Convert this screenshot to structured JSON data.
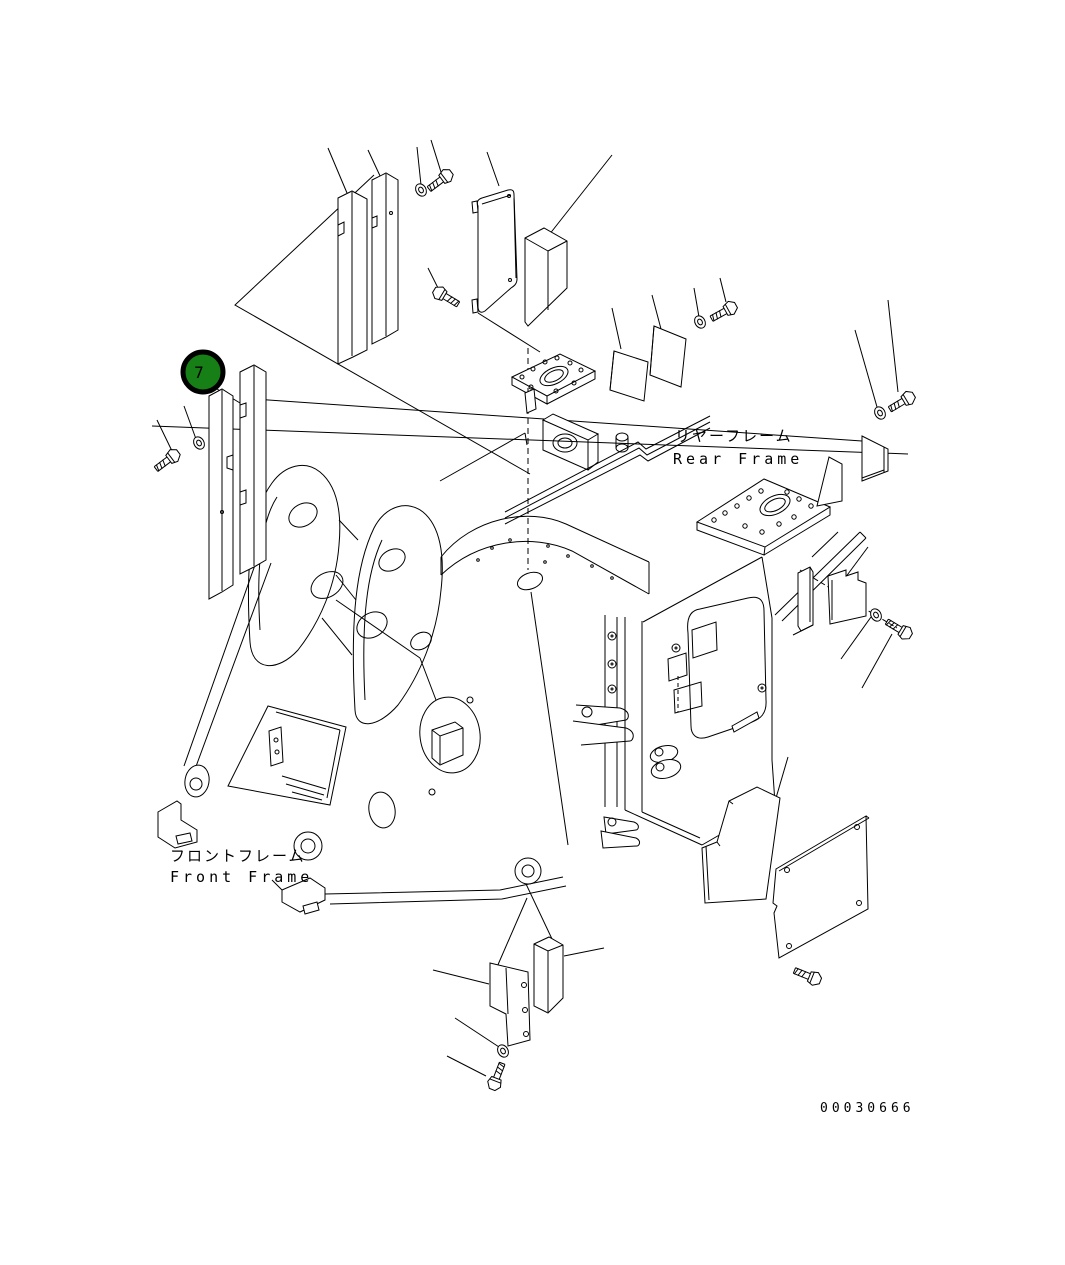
{
  "diagram": {
    "type": "parts-exploded-diagram",
    "drawing_number": "00030666",
    "callout": {
      "number": "7"
    },
    "labels": {
      "rear_frame_jp": "リヤーフレーム",
      "rear_frame_en": "Rear Frame",
      "front_frame_jp": "フロントフレーム",
      "front_frame_en": "Front Frame"
    },
    "colors": {
      "background": "#ffffff",
      "line": "#000000",
      "callout_fill": "#168016",
      "callout_ring": "#000000",
      "callout_text": "#ffffff"
    }
  }
}
